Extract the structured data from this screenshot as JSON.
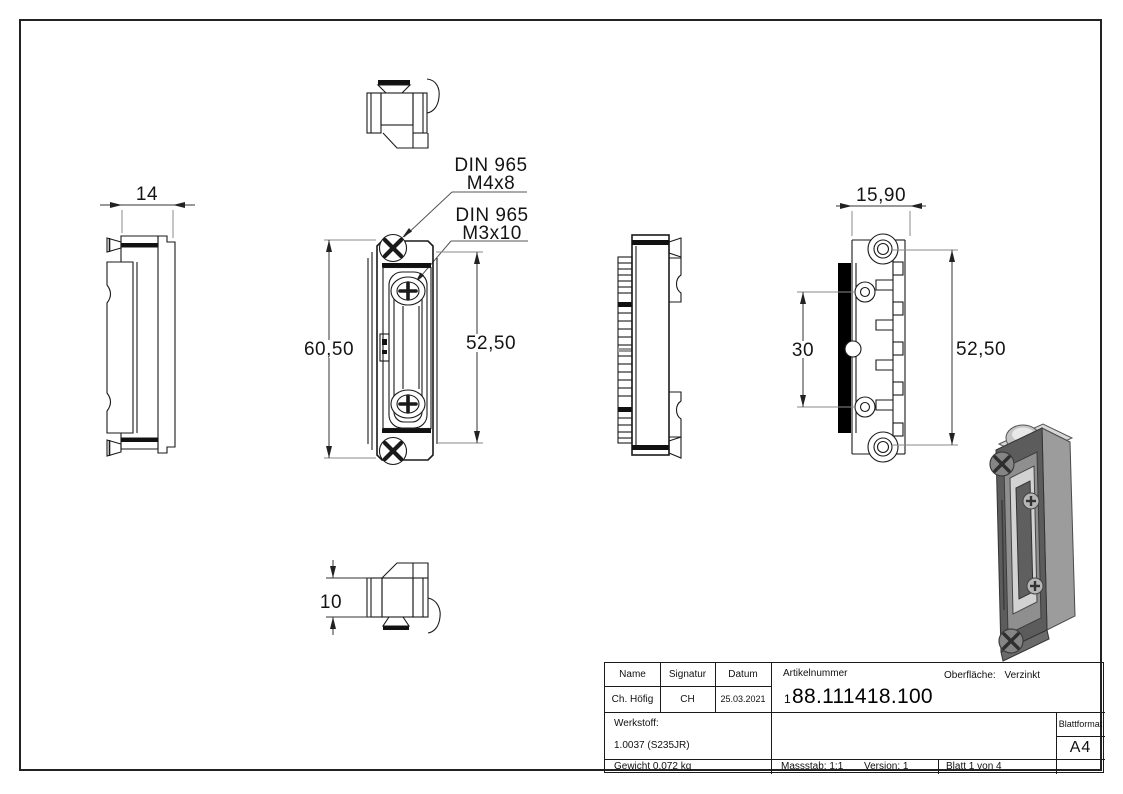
{
  "drawing": {
    "dimensions": {
      "side_width": "14",
      "front_height": "60,50",
      "front_screw_spacing": "52,50",
      "back_width": "15,90",
      "back_hole_spacing": "30",
      "back_screw_spacing": "52,50",
      "bottom_height": "10"
    },
    "annotations": {
      "screw_top": {
        "line1": "DIN 965",
        "line2": "M4x8"
      },
      "screw_inner": {
        "line1": "DIN 965",
        "line2": "M3x10"
      }
    }
  },
  "title_block": {
    "name_header": "Name",
    "signature_header": "Signatur",
    "date_header": "Datum",
    "name": "Ch. Höfig",
    "signature": "CH",
    "date": "25.03.2021",
    "article_label": "Artikelnummer",
    "article_prefix": "1",
    "article_number": "88.111418.100",
    "surface_label": "Oberfläche:",
    "surface_value": "Verzinkt",
    "material_label": "Werkstoff:",
    "material_value": "1.0037 (S235JR)",
    "weight": "Gewicht 0.072 kg",
    "scale": "Massstab: 1:1",
    "version": "Version: 1",
    "sheet": "Blatt 1 von 4",
    "format_label": "Blattformat",
    "format_value": "A4"
  }
}
